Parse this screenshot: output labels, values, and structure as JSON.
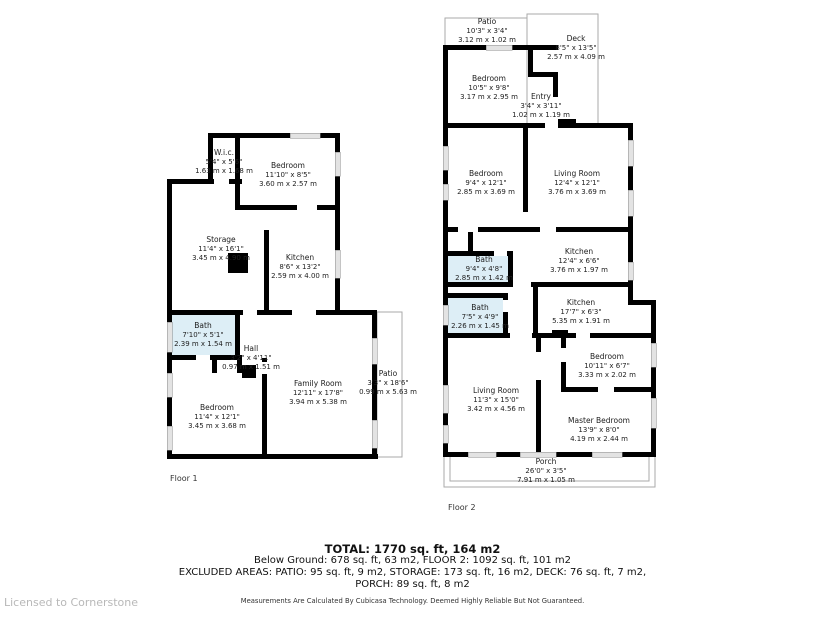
{
  "floor1": {
    "label": "Floor 1",
    "rooms": {
      "wic": {
        "name": "W.i.c.",
        "imperial": "5'4\" x 5'6\"",
        "metric": "1.63 m x 1.68 m"
      },
      "bedroom_top": {
        "name": "Bedroom",
        "imperial": "11'10\" x 8'5\"",
        "metric": "3.60 m x 2.57 m"
      },
      "storage": {
        "name": "Storage",
        "imperial": "11'4\" x 16'1\"",
        "metric": "3.45 m x 4.90 m"
      },
      "kitchen": {
        "name": "Kitchen",
        "imperial": "8'6\" x 13'2\"",
        "metric": "2.59 m x 4.00 m"
      },
      "bath": {
        "name": "Bath",
        "imperial": "7'10\" x 5'1\"",
        "metric": "2.39 m x 1.54 m"
      },
      "hall": {
        "name": "Hall",
        "imperial": "3'2\" x 4'11\"",
        "metric": "0.97 m x 1.51 m"
      },
      "bedroom_bottom": {
        "name": "Bedroom",
        "imperial": "11'4\" x 12'1\"",
        "metric": "3.45 m x 3.68 m"
      },
      "family_room": {
        "name": "Family Room",
        "imperial": "12'11\" x 17'8\"",
        "metric": "3.94 m x 5.38 m"
      },
      "patio": {
        "name": "Patio",
        "imperial": "3'3\" x 18'6\"",
        "metric": "0.99 m x 5.63 m"
      }
    }
  },
  "floor2": {
    "label": "Floor 2",
    "rooms": {
      "patio": {
        "name": "Patio",
        "imperial": "10'3\" x 3'4\"",
        "metric": "3.12 m x 1.02 m"
      },
      "deck": {
        "name": "Deck",
        "imperial": "8'5\" x 13'5\"",
        "metric": "2.57 m x 4.09 m"
      },
      "bedroom_top": {
        "name": "Bedroom",
        "imperial": "10'5\" x 9'8\"",
        "metric": "3.17 m x 2.95 m"
      },
      "entry": {
        "name": "Entry",
        "imperial": "3'4\" x 3'11\"",
        "metric": "1.02 m x 1.19 m"
      },
      "bedroom_mid": {
        "name": "Bedroom",
        "imperial": "9'4\" x 12'1\"",
        "metric": "2.85 m x 3.69 m"
      },
      "living_room_mid": {
        "name": "Living Room",
        "imperial": "12'4\" x 12'1\"",
        "metric": "3.76 m x 3.69 m"
      },
      "kitchen_upper": {
        "name": "Kitchen",
        "imperial": "12'4\" x 6'6\"",
        "metric": "3.76 m x 1.97 m"
      },
      "bath_upper": {
        "name": "Bath",
        "imperial": "9'4\" x 4'8\"",
        "metric": "2.85 m x 1.42 m"
      },
      "bath_lower": {
        "name": "Bath",
        "imperial": "7'5\" x 4'9\"",
        "metric": "2.26 m x 1.45 m"
      },
      "kitchen_lower": {
        "name": "Kitchen",
        "imperial": "17'7\" x 6'3\"",
        "metric": "5.35 m x 1.91 m"
      },
      "bedroom_small": {
        "name": "Bedroom",
        "imperial": "10'11\" x 6'7\"",
        "metric": "3.33 m x 2.02 m"
      },
      "living_room_bottom": {
        "name": "Living Room",
        "imperial": "11'3\" x 15'0\"",
        "metric": "3.42 m x 4.56 m"
      },
      "master_bedroom": {
        "name": "Master Bedroom",
        "imperial": "13'9\" x 8'0\"",
        "metric": "4.19 m x 2.44 m"
      },
      "porch": {
        "name": "Porch",
        "imperial": "26'0\" x 3'5\"",
        "metric": "7.91 m x 1.05 m"
      }
    }
  },
  "summary": {
    "total": "TOTAL: 1770 sq. ft, 164 m2",
    "line2": "Below Ground: 678 sq. ft, 63 m2, FLOOR 2: 1092 sq. ft, 101 m2",
    "line3": "EXCLUDED AREAS: PATIO: 95 sq. ft, 9 m2, STORAGE: 173 sq. ft, 16 m2, DECK: 76 sq. ft, 7 m2,",
    "line4": "PORCH: 89 sq. ft, 8 m2",
    "disclaimer": "Measurements Are Calculated By Cubicasa Technology. Deemed Highly Reliable But Not Guaranteed."
  },
  "license": "Licensed to Cornerstone",
  "colors": {
    "wall": "#000000",
    "bath_fill": "#ddeef6",
    "thin_outline": "#aaaaaa",
    "window": "#e3e3e3",
    "license_text": "#b8b8b8"
  }
}
